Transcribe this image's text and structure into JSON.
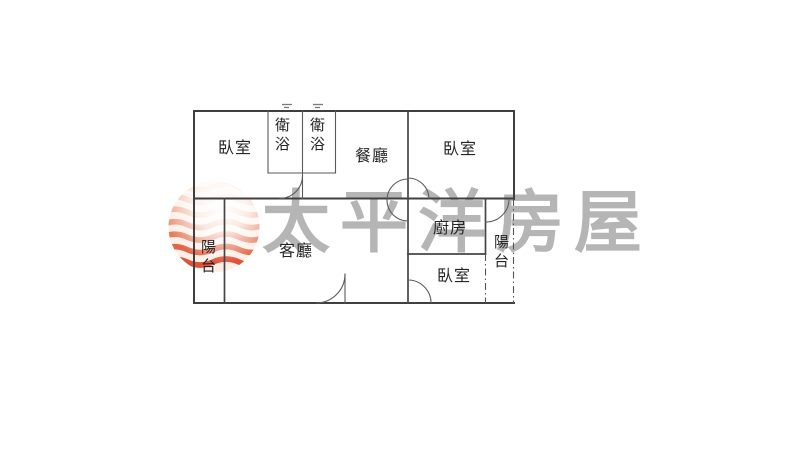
{
  "page": {
    "background": "#ffffff"
  },
  "watermark": {
    "brand_text": "太平洋房屋",
    "text_color": "#b5b5b5",
    "logo": {
      "name": "pacific-house-sphere-logo",
      "stripe_colors": [
        "#f7d3c3",
        "#f3bda8",
        "#efa78d",
        "#eb9174",
        "#e77b5c",
        "#e26547",
        "#dd5238"
      ],
      "highlight_color": "#ffffff"
    }
  },
  "floorplan": {
    "wall_color": "#3f3f3f",
    "thin_line_color": "#5a5a5a",
    "rooms": {
      "bedroom_top_left": "臥室",
      "bath_left": "衛浴",
      "bath_right": "衛浴",
      "dining": "餐廳",
      "bedroom_top_right": "臥室",
      "balcony_left": "陽台",
      "living": "客廳",
      "kitchen": "廚房",
      "balcony_right": "陽台",
      "bedroom_bottom": "臥室"
    }
  }
}
